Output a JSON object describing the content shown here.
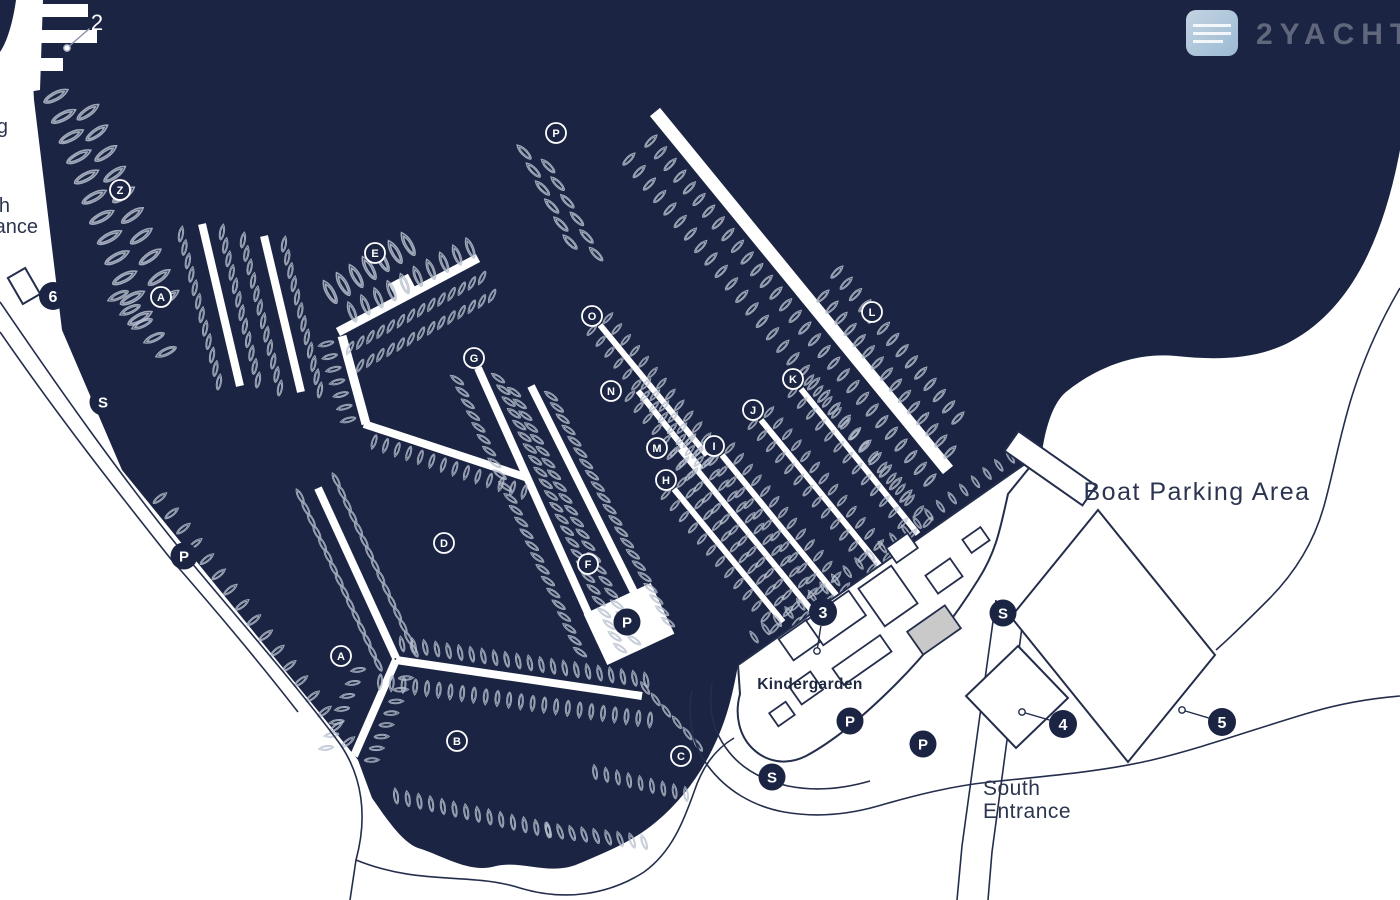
{
  "colors": {
    "water": "#1b2443",
    "land": "#ffffff",
    "boat_stroke": "#b9c1cf",
    "road": "#242e4c",
    "marker_fill": "#1b2443",
    "marker_text": "#ffffff",
    "building_gray": "#c9c9c9",
    "logo_blue_light": "#d7e7f3",
    "logo_blue_dark": "#a9cbe4"
  },
  "watermark": {
    "brand": "2YACHTS",
    "logo": "yacht-logo"
  },
  "labels": {
    "boat_parking_area": "Boat Parking Area",
    "south_entrance_1": "South",
    "south_entrance_2": "Entrance",
    "kindergarden": "Kindergarden",
    "edge_g": "g",
    "edge_th": "th",
    "edge_ance": "ance"
  },
  "pier_labels": [
    {
      "id": "Z",
      "x": 120,
      "y": 190
    },
    {
      "id": "A",
      "x": 161,
      "y": 297
    },
    {
      "id": "E",
      "x": 375,
      "y": 253
    },
    {
      "id": "P",
      "x": 556,
      "y": 133
    },
    {
      "id": "G",
      "x": 474,
      "y": 358
    },
    {
      "id": "O",
      "x": 592,
      "y": 316
    },
    {
      "id": "N",
      "x": 611,
      "y": 391
    },
    {
      "id": "M",
      "x": 657,
      "y": 448
    },
    {
      "id": "H",
      "x": 666,
      "y": 480
    },
    {
      "id": "I",
      "x": 714,
      "y": 446
    },
    {
      "id": "J",
      "x": 753,
      "y": 410
    },
    {
      "id": "K",
      "x": 793,
      "y": 379
    },
    {
      "id": "L",
      "x": 872,
      "y": 312
    },
    {
      "id": "D",
      "x": 444,
      "y": 543
    },
    {
      "id": "F",
      "x": 588,
      "y": 564
    },
    {
      "id": "A",
      "x": 341,
      "y": 656
    },
    {
      "id": "B",
      "x": 457,
      "y": 741
    },
    {
      "id": "C",
      "x": 681,
      "y": 756
    }
  ],
  "number_markers": [
    {
      "label": "2",
      "x": 97,
      "y": 22,
      "style": "plain",
      "dot": {
        "x": 67,
        "y": 48
      }
    },
    {
      "label": "3",
      "x": 823,
      "y": 612,
      "style": "filled",
      "dot": {
        "x": 817,
        "y": 651
      }
    },
    {
      "label": "4",
      "x": 1063,
      "y": 724,
      "style": "filled",
      "dot": {
        "x": 1022,
        "y": 712
      }
    },
    {
      "label": "5",
      "x": 1222,
      "y": 722,
      "style": "filled",
      "dot": {
        "x": 1182,
        "y": 710
      }
    },
    {
      "label": "6",
      "x": 53,
      "y": 296,
      "style": "filled",
      "dot": null
    }
  ],
  "amenity_markers": [
    {
      "type": "S",
      "x": 103,
      "y": 402
    },
    {
      "type": "S",
      "x": 772,
      "y": 777
    },
    {
      "type": "S",
      "x": 1003,
      "y": 613
    },
    {
      "type": "P",
      "x": 184,
      "y": 556
    },
    {
      "type": "P",
      "x": 627,
      "y": 622
    },
    {
      "type": "P",
      "x": 850,
      "y": 721
    },
    {
      "type": "P",
      "x": 923,
      "y": 744
    }
  ]
}
